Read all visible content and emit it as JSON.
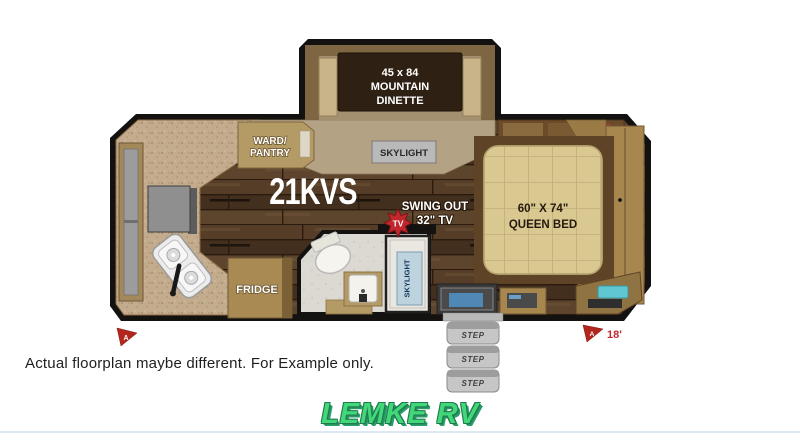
{
  "page": {
    "disclaimer": "Actual floorplan maybe different. For Example only.",
    "brand": "LEMKE RV",
    "brand_color": "#43d877"
  },
  "floorplan": {
    "model": "21KVS",
    "dinette": {
      "line1": "45 x 84",
      "line2": "MOUNTAIN",
      "line3": "DINETTE"
    },
    "skylight_dinette": "SKYLIGHT",
    "wardrobe_pantry": {
      "line1": "WARD/",
      "line2": "PANTRY"
    },
    "fridge": "FRIDGE",
    "tv": {
      "badge": "TV",
      "line1": "SWING OUT",
      "line2": "32\" TV"
    },
    "skylight_bath": "SKYLIGHT",
    "bed": {
      "line1": "60\" X 74\"",
      "line2": "QUEEN BED"
    },
    "steps": [
      "STEP",
      "STEP",
      "STEP"
    ],
    "awning": {
      "left_label": "A",
      "right_label": "A",
      "right_length": "18'"
    },
    "colors": {
      "wall": "#141210",
      "wood_floor": "#4a3421",
      "carpet": "#c3ab8d",
      "mattress": "#d9c88f",
      "accent_red": "#c1272d",
      "cabinet_wood": "#a8874f"
    }
  }
}
